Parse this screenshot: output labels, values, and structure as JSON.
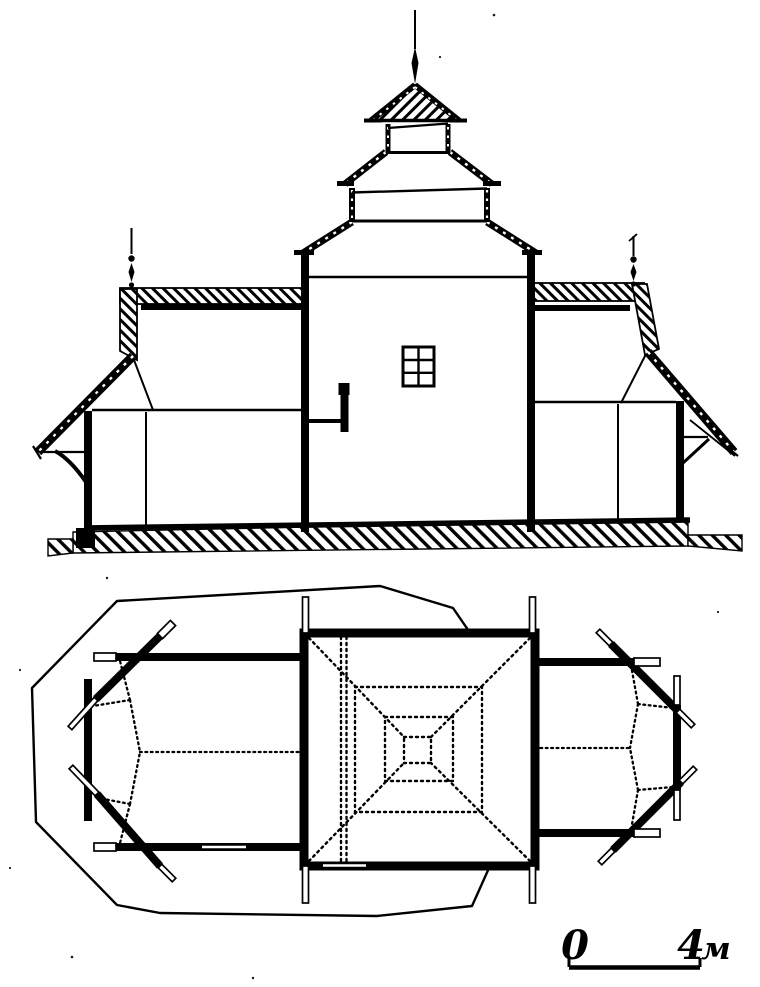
{
  "colors": {
    "ink": "#000000",
    "paper": "#ffffff"
  },
  "scale_bar": {
    "zero": "0",
    "end_value": "4",
    "end_unit": "м"
  }
}
